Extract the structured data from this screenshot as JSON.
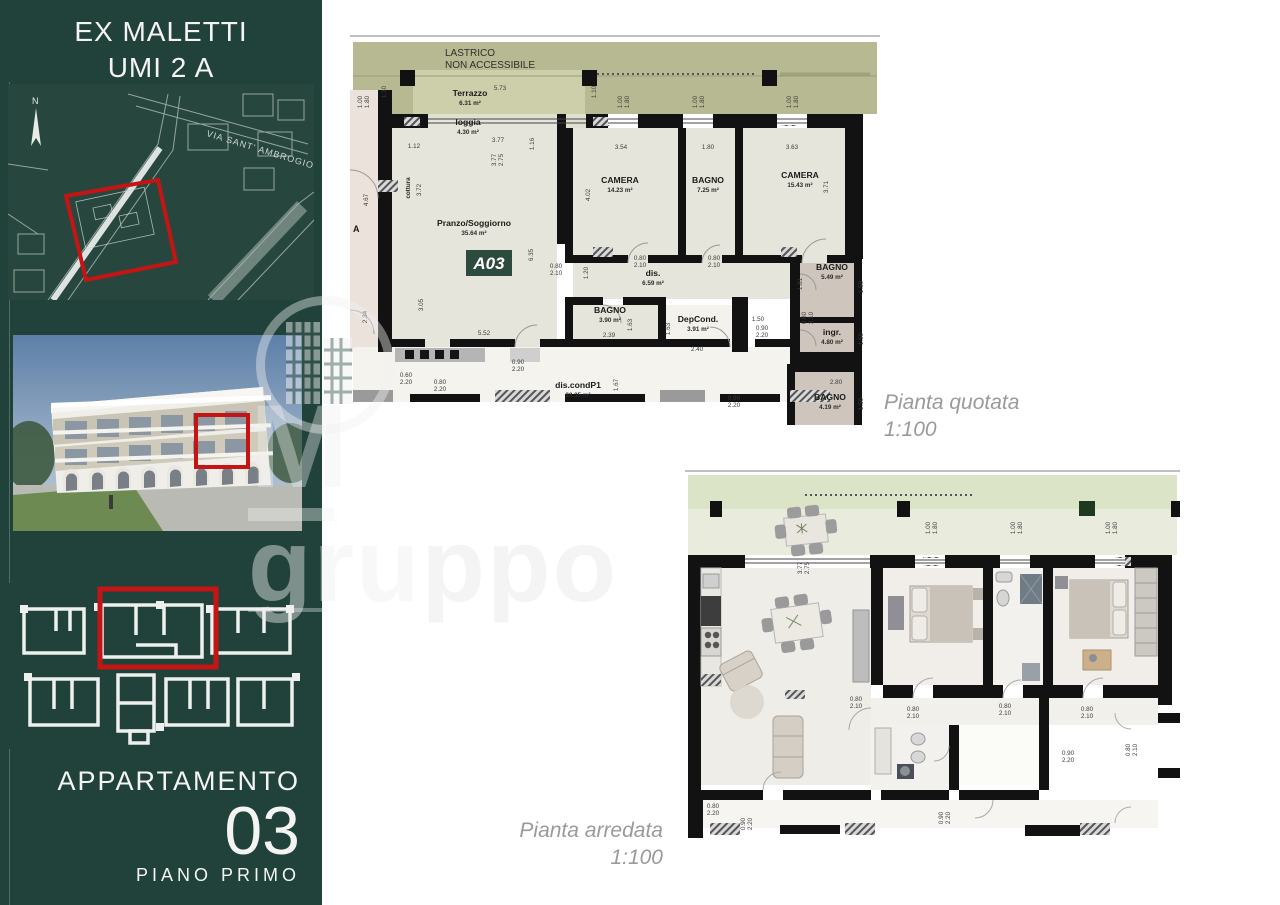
{
  "sidebar": {
    "title_line1": "EX MALETTI",
    "title_line2": "UMI 2 A",
    "site_map": {
      "north_label": "N",
      "street_label": "VIA SANT' AMBROGIO"
    },
    "apartment_label": "APPARTAMENTO",
    "apartment_number": "03",
    "floor_label": "PIANO PRIMO",
    "colors": {
      "background": "#20423a",
      "highlight": "#c41414"
    }
  },
  "watermark": {
    "letter": "M",
    "word_visible": "gru",
    "word_faint": "ppo"
  },
  "plans": {
    "quotata": {
      "caption_title": "Pianta quotata",
      "caption_scale": "1:100",
      "roof_label_line1": "LASTRICO",
      "roof_label_line2": "NON ACCESSIBILE",
      "unit_badge": "A03",
      "neighbor_label": "A",
      "labels": [
        {
          "t": "Terrazzo",
          "s": "6.31 m²",
          "x": 120,
          "y": 66
        },
        {
          "t": "loggia",
          "s": "4.30 m²",
          "x": 118,
          "y": 95
        },
        {
          "t": "Pranzo/Soggiorno",
          "s": "35.64 m²",
          "x": 124,
          "y": 196
        },
        {
          "t": "cottura",
          "x": 60,
          "y": 158,
          "rot": -90,
          "small": 1
        },
        {
          "t": "CAMERA",
          "s": "14.23 m²",
          "x": 270,
          "y": 153
        },
        {
          "t": "BAGNO",
          "s": "7.25 m²",
          "x": 358,
          "y": 153
        },
        {
          "t": "CAMERA",
          "s": "15.43 m²",
          "x": 450,
          "y": 148
        },
        {
          "t": "dis.",
          "s": "6.59 m²",
          "x": 303,
          "y": 246
        },
        {
          "t": "BAGNO",
          "s": "3.90 m²",
          "x": 260,
          "y": 283
        },
        {
          "t": "DepCond.",
          "s": "3.91 m²",
          "x": 348,
          "y": 292
        },
        {
          "t": "BAGNO",
          "s": "5.49 m²",
          "x": 482,
          "y": 240
        },
        {
          "t": "ingr.",
          "s": "4.80 m²",
          "x": 482,
          "y": 305
        },
        {
          "t": "BAGNO",
          "s": "4.19 m²",
          "x": 480,
          "y": 370
        },
        {
          "t": "dis.condP1",
          "s": "23.35 m²",
          "x": 228,
          "y": 358
        }
      ],
      "dims": [
        {
          "l": [
            "5.73"
          ],
          "x": 150,
          "y": 60
        },
        {
          "l": [
            "1.30"
          ],
          "x": 36,
          "y": 62,
          "rot": -90
        },
        {
          "l": [
            "1.10"
          ],
          "x": 246,
          "y": 62,
          "rot": -90
        },
        {
          "l": [
            "1.00",
            "1.80"
          ],
          "x": 12,
          "y": 72,
          "rot": -90
        },
        {
          "l": [
            "1.00",
            "1.80"
          ],
          "x": 272,
          "y": 72,
          "rot": -90
        },
        {
          "l": [
            "1.00",
            "1.80"
          ],
          "x": 347,
          "y": 72,
          "rot": -90
        },
        {
          "l": [
            "1.00",
            "1.80"
          ],
          "x": 441,
          "y": 72,
          "rot": -90
        },
        {
          "l": [
            "3.77"
          ],
          "x": 148,
          "y": 112
        },
        {
          "l": [
            "3.77",
            "2.75"
          ],
          "x": 146,
          "y": 130,
          "rot": -90
        },
        {
          "l": [
            "1.16"
          ],
          "x": 184,
          "y": 114,
          "rot": -90
        },
        {
          "l": [
            "1.12"
          ],
          "x": 64,
          "y": 118
        },
        {
          "l": [
            "3.72"
          ],
          "x": 71,
          "y": 160,
          "rot": -90
        },
        {
          "l": [
            "4.67"
          ],
          "x": 18,
          "y": 170,
          "rot": -90
        },
        {
          "l": [
            "2.34"
          ],
          "x": 17,
          "y": 287,
          "rot": -90
        },
        {
          "l": [
            "3.05"
          ],
          "x": 73,
          "y": 275,
          "rot": -90
        },
        {
          "l": [
            "5.52"
          ],
          "x": 134,
          "y": 305
        },
        {
          "l": [
            "6.35"
          ],
          "x": 183,
          "y": 225,
          "rot": -90
        },
        {
          "l": [
            "4.02"
          ],
          "x": 240,
          "y": 165,
          "rot": -90
        },
        {
          "l": [
            "3.54"
          ],
          "x": 271,
          "y": 119
        },
        {
          "l": [
            "1.80"
          ],
          "x": 358,
          "y": 119
        },
        {
          "l": [
            "3.63"
          ],
          "x": 442,
          "y": 119
        },
        {
          "l": [
            "3.71"
          ],
          "x": 478,
          "y": 157,
          "rot": -90
        },
        {
          "l": [
            "1.20"
          ],
          "x": 238,
          "y": 243,
          "rot": -90
        },
        {
          "l": [
            "0.80",
            "2.10"
          ],
          "x": 206,
          "y": 238
        },
        {
          "l": [
            "0.80",
            "2.10"
          ],
          "x": 290,
          "y": 230
        },
        {
          "l": [
            "0.80",
            "2.10"
          ],
          "x": 364,
          "y": 230
        },
        {
          "l": [
            "2.39"
          ],
          "x": 259,
          "y": 307
        },
        {
          "l": [
            "1.63"
          ],
          "x": 282,
          "y": 295,
          "rot": -90
        },
        {
          "l": [
            "2.40"
          ],
          "x": 347,
          "y": 321
        },
        {
          "l": [
            "1.63"
          ],
          "x": 320,
          "y": 299,
          "rot": -90
        },
        {
          "l": [
            "1.50"
          ],
          "x": 408,
          "y": 291
        },
        {
          "l": [
            "1.81"
          ],
          "x": 452,
          "y": 254,
          "rot": -90
        },
        {
          "l": [
            "1.50"
          ],
          "x": 513,
          "y": 257,
          "rot": -90
        },
        {
          "l": [
            "0.80",
            "2.10"
          ],
          "x": 456,
          "y": 288,
          "rot": -90
        },
        {
          "l": [
            "0.90",
            "2.20"
          ],
          "x": 412,
          "y": 300
        },
        {
          "l": [
            "1.50"
          ],
          "x": 513,
          "y": 309,
          "rot": -90
        },
        {
          "l": [
            "2.80"
          ],
          "x": 486,
          "y": 354
        },
        {
          "l": [
            "1.50"
          ],
          "x": 513,
          "y": 374,
          "rot": -90
        },
        {
          "l": [
            "0.90",
            "2.20"
          ],
          "x": 168,
          "y": 334
        },
        {
          "l": [
            "0.60",
            "2.20"
          ],
          "x": 56,
          "y": 347
        },
        {
          "l": [
            "0.80",
            "2.20"
          ],
          "x": 90,
          "y": 354
        },
        {
          "l": [
            "1.67"
          ],
          "x": 268,
          "y": 355,
          "rot": -90
        },
        {
          "l": [
            "0.90",
            "2.20"
          ],
          "x": 384,
          "y": 370
        }
      ]
    },
    "arredata": {
      "caption_title": "Pianta arredata",
      "caption_scale": "1:100",
      "dims": [
        {
          "l": [
            "1.00",
            "1.80"
          ],
          "x": 245,
          "y": 60,
          "rot": -90
        },
        {
          "l": [
            "1.00",
            "1.80"
          ],
          "x": 330,
          "y": 60,
          "rot": -90
        },
        {
          "l": [
            "1.00",
            "1.80"
          ],
          "x": 425,
          "y": 60,
          "rot": -90
        },
        {
          "l": [
            "3.77",
            "2.75"
          ],
          "x": 117,
          "y": 100,
          "rot": -90
        },
        {
          "l": [
            "0.80",
            "2.10"
          ],
          "x": 171,
          "y": 233
        },
        {
          "l": [
            "0.80",
            "2.10"
          ],
          "x": 228,
          "y": 243
        },
        {
          "l": [
            "0.80",
            "2.10"
          ],
          "x": 320,
          "y": 240
        },
        {
          "l": [
            "0.80",
            "2.10"
          ],
          "x": 402,
          "y": 243
        },
        {
          "l": [
            "0.80",
            "2.10"
          ],
          "x": 445,
          "y": 282,
          "rot": -90
        },
        {
          "l": [
            "0.90",
            "2.20"
          ],
          "x": 383,
          "y": 287
        },
        {
          "l": [
            "0.90",
            "2.20"
          ],
          "x": 258,
          "y": 350,
          "rot": -90
        },
        {
          "l": [
            "0.80",
            "2.20"
          ],
          "x": 28,
          "y": 340
        },
        {
          "l": [
            "0.90",
            "2.20"
          ],
          "x": 60,
          "y": 356,
          "rot": -90
        }
      ]
    }
  }
}
